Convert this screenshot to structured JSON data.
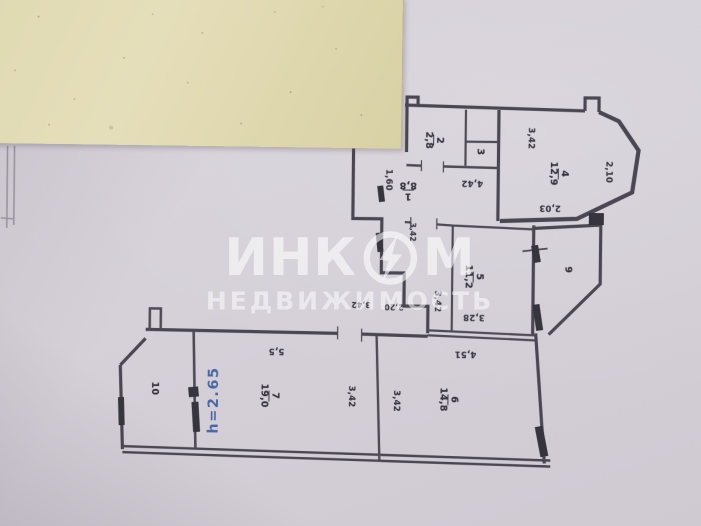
{
  "watermark": {
    "prefix": "ИНК",
    "suffix": "М",
    "subtitle": "НЕДВИЖИМОСТЬ",
    "logo": "lightning-circle-icon"
  },
  "blue_note": "h=2.65",
  "rooms": [
    {
      "num": "1",
      "area": "8,8"
    },
    {
      "num": "2",
      "area": "2,8"
    },
    {
      "num": "3",
      "area": ""
    },
    {
      "num": "4",
      "area": "12,9"
    },
    {
      "num": "5",
      "area": "11,2"
    },
    {
      "num": "6",
      "area": "14,8"
    },
    {
      "num": "7",
      "area": "19,0"
    },
    {
      "num": "9",
      "area": ""
    },
    {
      "num": "10",
      "area": ""
    }
  ],
  "dims": [
    "3,42",
    "2,10",
    "2,03",
    "4,42",
    "1,60",
    "3,42",
    "3,42",
    "3,28",
    "4,51",
    "3,42",
    "3,42",
    "5,5",
    "3,42",
    "2,20"
  ]
}
